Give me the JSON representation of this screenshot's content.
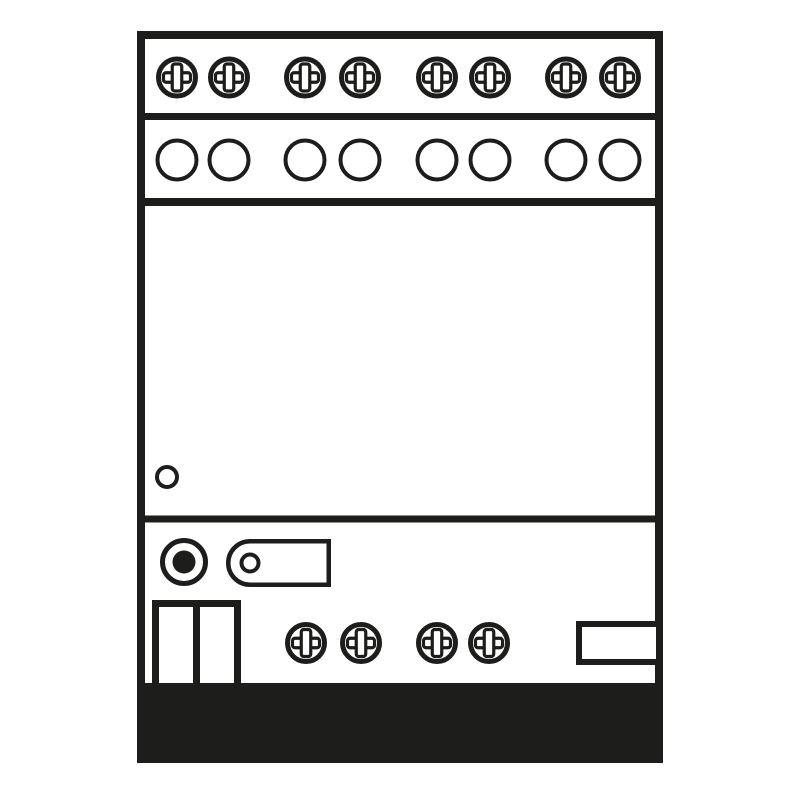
{
  "diagram": {
    "background": "#ffffff",
    "ink": "#1d1d1b",
    "canvas": {
      "width": 800,
      "height": 800
    },
    "device_outline": {
      "x": 137,
      "y": 31,
      "width": 526,
      "height": 732,
      "stroke": 8
    },
    "section_dividers": [
      {
        "name": "top-terminal-divider",
        "y": 116.5,
        "stroke": 7
      },
      {
        "name": "wire-entry-divider",
        "y": 202,
        "stroke": 8
      },
      {
        "name": "front-panel-divider",
        "y": 519,
        "stroke": 7
      }
    ],
    "top_screw_row": {
      "icon": "screw-terminal-icon",
      "cy": 77.5,
      "outer_d": 42,
      "cx": [
        177,
        229,
        305,
        360,
        437,
        490,
        566,
        620
      ]
    },
    "wire_hole_row": {
      "icon": "terminal-hole-icon",
      "cy": 160,
      "outer_d": 43,
      "stroke": 4,
      "cx": [
        177,
        229,
        305,
        360,
        437,
        490,
        566,
        620
      ]
    },
    "status_led": {
      "icon": "status-led-icon",
      "cx": 167,
      "cy": 477,
      "outer_d": 24,
      "stroke": 4
    },
    "programming_button": {
      "icon": "programming-button-icon",
      "cx": 184,
      "cy": 562,
      "outer_d": 48,
      "ring_stroke": 5,
      "dot_d": 23
    },
    "label_tab": {
      "icon": "label-tab-icon",
      "x": 226,
      "y": 539,
      "width": 105,
      "height": 48,
      "corner_radius": 24,
      "stroke": 4.5,
      "hole_cx": 250,
      "hole_cy": 563,
      "hole_d": 21,
      "hole_stroke": 4
    },
    "bus_terminal_block": {
      "icon": "bus-terminal-block",
      "x": 152,
      "y": 600,
      "width": 89,
      "height": 92,
      "stroke": 7,
      "divider_x": 196.5,
      "cells": 2
    },
    "bottom_screw_row": {
      "icon": "screw-terminal-icon",
      "cy": 643,
      "outer_d": 42,
      "cx": [
        306,
        361,
        437,
        489
      ]
    },
    "aux_connector": {
      "icon": "aux-connector",
      "x": 576,
      "y": 621,
      "width": 86,
      "height": 44,
      "stroke": 6
    },
    "din_rail_bar": {
      "icon": "din-rail-bar",
      "x": 137,
      "y": 683,
      "width": 526,
      "height": 80
    },
    "screw_glyph": {
      "ring_r": 18.5,
      "ring_stroke": 5,
      "bar_length": 27,
      "bar_width": 9.5,
      "bar_corner": 2.5,
      "bar_stroke": 3.2
    }
  }
}
